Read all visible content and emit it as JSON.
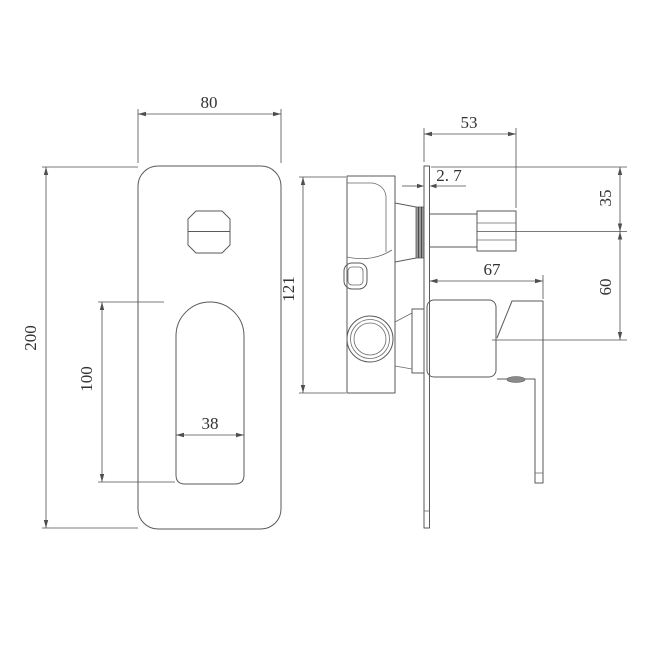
{
  "drawing": {
    "type": "technical-orthographic-drawing",
    "subject": "concealed shower mixer valve, front and side views",
    "colors": {
      "background": "#ffffff",
      "line": "#5a5a5a",
      "text": "#323232"
    },
    "front_view": {
      "plate_width_label": "80",
      "plate_height_label": "200",
      "handle_length_label": "100",
      "handle_width_label": "38"
    },
    "side_view": {
      "knob_projection_label": "53",
      "plate_thickness_label": "2. 7",
      "body_height_label": "121",
      "top_to_knob_center_label": "35",
      "knob_to_handle_center_label": "60",
      "handle_projection_label": "67"
    }
  }
}
